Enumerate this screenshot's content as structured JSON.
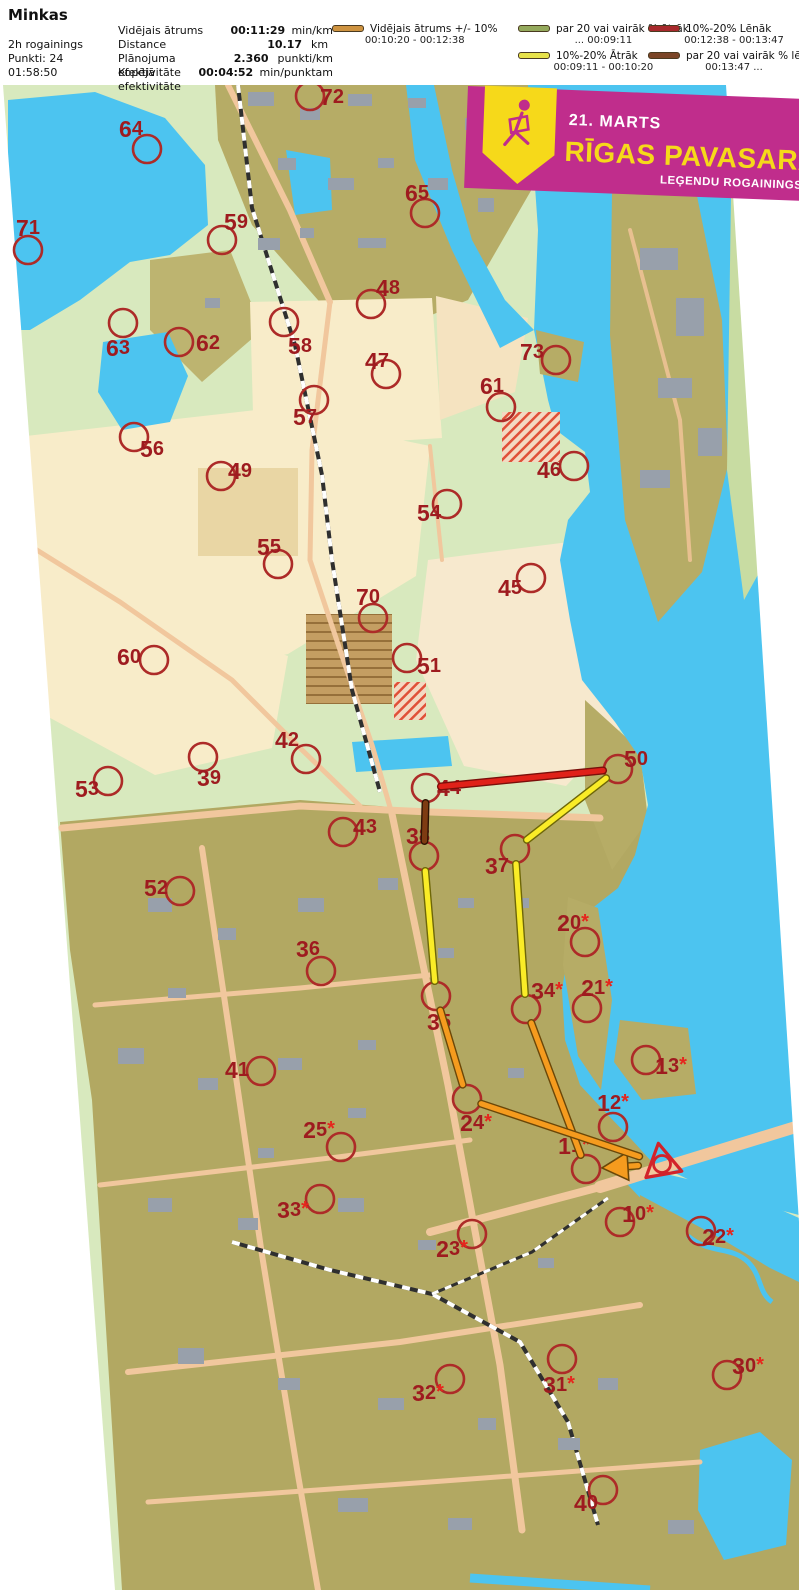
{
  "header": {
    "title": "Minkas",
    "left_lines": [
      "2h rogainings",
      "Punkti: 24",
      "01:58:50"
    ],
    "stats": [
      {
        "label": "Vidējais ātrums",
        "value": "00:11:29",
        "unit": "min/km"
      },
      {
        "label": "Distance",
        "value": "10.17",
        "unit": "km"
      },
      {
        "label": "Plānojuma efektivitāte",
        "value": "2.360",
        "unit": "punkti/km"
      },
      {
        "label": "Kopējā efektivitāte",
        "value": "00:04:52",
        "unit": "min/punktam"
      }
    ]
  },
  "legend": {
    "columns": [
      {
        "x": 2,
        "items": [
          {
            "color": "#CE9340",
            "label": "Vidējais ātrums +/- 10%",
            "range": "00:10:20   -   00:12:38"
          }
        ]
      },
      {
        "x": 188,
        "items": [
          {
            "color": "#94A95C",
            "label": "par 20 vai vairāk % ātrāk",
            "range": "...   00:09:11"
          },
          {
            "color": "#E7E24A",
            "label": "10%-20% Ātrāk",
            "range": "00:09:11   -   00:10:20"
          }
        ]
      },
      {
        "x": 318,
        "items": [
          {
            "color": "#A8292C",
            "label": "10%-20% Lēnāk",
            "range": "00:12:38   -   00:13:47"
          },
          {
            "color": "#7B4527",
            "label": "par 20 vai vairāk % lēnāk",
            "range": "00:13:47   ..."
          }
        ]
      }
    ]
  },
  "banner": {
    "date": "21. MARTS",
    "title": "RĪGAS PAVASARA",
    "subtitle": "LEĢENDU ROGAININGS",
    "bg": "#C02D8C",
    "accent": "#F6D91A"
  },
  "map": {
    "circle_color": "#AD2B28",
    "label_color": "#9E1B1F",
    "star_color": "#E6261D",
    "controls": [
      {
        "n": "72",
        "star": false,
        "lx": 332,
        "ly": 97,
        "cx": 310,
        "cy": 96
      },
      {
        "n": "64",
        "star": false,
        "lx": 131,
        "ly": 129,
        "cx": 147,
        "cy": 149
      },
      {
        "n": "65",
        "star": false,
        "lx": 417,
        "ly": 193,
        "cx": 425,
        "cy": 213
      },
      {
        "n": "71",
        "star": false,
        "lx": 28,
        "ly": 228,
        "cx": 28,
        "cy": 250
      },
      {
        "n": "59",
        "star": false,
        "lx": 236,
        "ly": 222,
        "cx": 222,
        "cy": 240
      },
      {
        "n": "48",
        "star": false,
        "lx": 388,
        "ly": 288,
        "cx": 371,
        "cy": 304
      },
      {
        "n": "63",
        "star": false,
        "lx": 118,
        "ly": 348,
        "cx": 123,
        "cy": 323
      },
      {
        "n": "62",
        "star": false,
        "lx": 208,
        "ly": 343,
        "cx": 179,
        "cy": 342
      },
      {
        "n": "58",
        "star": false,
        "lx": 300,
        "ly": 346,
        "cx": 284,
        "cy": 322
      },
      {
        "n": "47",
        "star": false,
        "lx": 377,
        "ly": 361,
        "cx": 386,
        "cy": 374
      },
      {
        "n": "73",
        "star": false,
        "lx": 532,
        "ly": 352,
        "cx": 556,
        "cy": 360
      },
      {
        "n": "61",
        "star": false,
        "lx": 492,
        "ly": 386,
        "cx": 501,
        "cy": 407
      },
      {
        "n": "57",
        "star": false,
        "lx": 305,
        "ly": 417,
        "cx": 314,
        "cy": 400
      },
      {
        "n": "56",
        "star": false,
        "lx": 152,
        "ly": 449,
        "cx": 134,
        "cy": 437
      },
      {
        "n": "49",
        "star": false,
        "lx": 240,
        "ly": 471,
        "cx": 221,
        "cy": 476
      },
      {
        "n": "46",
        "star": false,
        "lx": 549,
        "ly": 470,
        "cx": 574,
        "cy": 466
      },
      {
        "n": "54",
        "star": false,
        "lx": 429,
        "ly": 513,
        "cx": 447,
        "cy": 504
      },
      {
        "n": "55",
        "star": false,
        "lx": 269,
        "ly": 547,
        "cx": 278,
        "cy": 564
      },
      {
        "n": "45",
        "star": false,
        "lx": 510,
        "ly": 588,
        "cx": 531,
        "cy": 578
      },
      {
        "n": "70",
        "star": false,
        "lx": 368,
        "ly": 597,
        "cx": 373,
        "cy": 618
      },
      {
        "n": "60",
        "star": false,
        "lx": 129,
        "ly": 657,
        "cx": 154,
        "cy": 660
      },
      {
        "n": "51",
        "star": false,
        "lx": 429,
        "ly": 666,
        "cx": 407,
        "cy": 658
      },
      {
        "n": "42",
        "star": false,
        "lx": 287,
        "ly": 740,
        "cx": 306,
        "cy": 759
      },
      {
        "n": "39",
        "star": false,
        "lx": 209,
        "ly": 778,
        "cx": 203,
        "cy": 757
      },
      {
        "n": "53",
        "star": false,
        "lx": 87,
        "ly": 789,
        "cx": 108,
        "cy": 781
      },
      {
        "n": "44",
        "star": false,
        "lx": 449,
        "ly": 788,
        "cx": 426,
        "cy": 788
      },
      {
        "n": "50",
        "star": false,
        "lx": 636,
        "ly": 759,
        "cx": 618,
        "cy": 769
      },
      {
        "n": "43",
        "star": false,
        "lx": 365,
        "ly": 827,
        "cx": 343,
        "cy": 832
      },
      {
        "n": "38",
        "star": false,
        "lx": 418,
        "ly": 836,
        "cx": 424,
        "cy": 856
      },
      {
        "n": "37",
        "star": false,
        "lx": 497,
        "ly": 866,
        "cx": 515,
        "cy": 849
      },
      {
        "n": "52",
        "star": false,
        "lx": 156,
        "ly": 888,
        "cx": 180,
        "cy": 891
      },
      {
        "n": "20",
        "star": true,
        "lx": 573,
        "ly": 923,
        "cx": 585,
        "cy": 942
      },
      {
        "n": "36",
        "star": false,
        "lx": 308,
        "ly": 949,
        "cx": 321,
        "cy": 971
      },
      {
        "n": "34",
        "star": true,
        "lx": 547,
        "ly": 991,
        "cx": 526,
        "cy": 1009
      },
      {
        "n": "21",
        "star": true,
        "lx": 597,
        "ly": 988,
        "cx": 587,
        "cy": 1008
      },
      {
        "n": "35",
        "star": false,
        "lx": 439,
        "ly": 1022,
        "cx": 436,
        "cy": 996
      },
      {
        "n": "13",
        "star": true,
        "lx": 671,
        "ly": 1066,
        "cx": 646,
        "cy": 1060
      },
      {
        "n": "41",
        "star": false,
        "lx": 237,
        "ly": 1070,
        "cx": 261,
        "cy": 1071
      },
      {
        "n": "12",
        "star": true,
        "lx": 613,
        "ly": 1103,
        "cx": 613,
        "cy": 1127
      },
      {
        "n": "24",
        "star": true,
        "lx": 476,
        "ly": 1123,
        "cx": 467,
        "cy": 1099
      },
      {
        "n": "25",
        "star": true,
        "lx": 319,
        "ly": 1130,
        "cx": 341,
        "cy": 1147
      },
      {
        "n": "11",
        "star": true,
        "lx": 574,
        "ly": 1146,
        "cx": 586,
        "cy": 1169
      },
      {
        "n": "33",
        "star": true,
        "lx": 293,
        "ly": 1210,
        "cx": 320,
        "cy": 1199
      },
      {
        "n": "23",
        "star": true,
        "lx": 452,
        "ly": 1249,
        "cx": 472,
        "cy": 1234
      },
      {
        "n": "10",
        "star": true,
        "lx": 638,
        "ly": 1214,
        "cx": 620,
        "cy": 1222
      },
      {
        "n": "22",
        "star": true,
        "lx": 718,
        "ly": 1237,
        "cx": 701,
        "cy": 1231
      },
      {
        "n": "31",
        "star": true,
        "lx": 559,
        "ly": 1385,
        "cx": 562,
        "cy": 1359
      },
      {
        "n": "32",
        "star": true,
        "lx": 428,
        "ly": 1393,
        "cx": 450,
        "cy": 1379
      },
      {
        "n": "30",
        "star": true,
        "lx": 748,
        "ly": 1366,
        "cx": 727,
        "cy": 1375
      },
      {
        "n": "40",
        "star": false,
        "lx": 586,
        "ly": 1503,
        "cx": 603,
        "cy": 1490
      }
    ],
    "route": {
      "start": {
        "x": 662,
        "y": 1164
      },
      "colors": {
        "orange": "#F59B1E",
        "yellow": "#FAEC27",
        "red": "#E02119",
        "brown": "#7E3B12"
      },
      "legs": [
        {
          "from": "START",
          "to": "11",
          "color": "orange",
          "arrow": true
        },
        {
          "from": "11",
          "to": "34",
          "color": "orange"
        },
        {
          "from": "34",
          "to": "37",
          "color": "yellow"
        },
        {
          "from": "37",
          "to": "50",
          "color": "yellow"
        },
        {
          "from": "50",
          "to": "44",
          "color": "red"
        },
        {
          "from": "44",
          "to": "38",
          "color": "brown"
        },
        {
          "from": "38",
          "to": "35",
          "color": "yellow"
        },
        {
          "from": "35",
          "to": "24",
          "color": "orange"
        },
        {
          "from": "24",
          "to": "START",
          "color": "orange"
        }
      ]
    }
  }
}
